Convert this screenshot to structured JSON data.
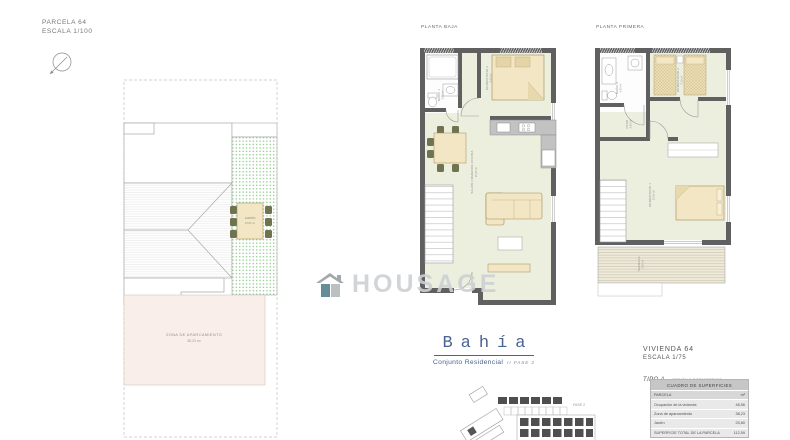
{
  "site": {
    "title": "PARCELA 64",
    "scale": "ESCALA 1/100",
    "garden": {
      "name": "JARDÍN",
      "area": "25,80 m²"
    },
    "parking": {
      "name": "ZONA DE APARCAMIENTO",
      "area": "38,23 m²"
    }
  },
  "plans": {
    "ground": {
      "title": "PLANTA BAJA",
      "bath": {
        "name": "BAÑO 1",
        "area": "3,85 m²"
      },
      "bedroom": {
        "name": "DORMITORIO 2",
        "area": "9,05 m²"
      },
      "living": {
        "name": "SALÓN COMEDOR-COCINA",
        "area": "25,90 m²"
      }
    },
    "first": {
      "title": "PLANTA PRIMERA",
      "bath": {
        "name": "BAÑO 2",
        "area": "4,20 m²"
      },
      "hall": {
        "name": "PASO",
        "area": "2,95 m²"
      },
      "bedroom2": {
        "name": "DORMITORIO 2",
        "area": "9,15 m²"
      },
      "bedroom1": {
        "name": "DORMITORIO 1",
        "area": "10,90 m²"
      },
      "terrace": {
        "name": "TERRAZA",
        "area": "9,60 m²"
      }
    }
  },
  "watermark": {
    "text": "HOUSAGE"
  },
  "brand": {
    "name": "Bahía",
    "subtitle": "Conjunto Residencial",
    "phase": "II FASE 2"
  },
  "unit": {
    "title": "VIVIENDA 64",
    "scale": "ESCALA 1/75",
    "type": "TIPO A",
    "type_note": "- OPCIÓN 3 DORMITORIOS"
  },
  "surfaces": {
    "title": "CUADRO DE SUPERFICIES",
    "header": {
      "label": "PARCELA",
      "unit": "m²"
    },
    "rows": [
      {
        "label": "Ocupación de la vivienda",
        "value": "48,56"
      },
      {
        "label": "Zona de aparcamiento",
        "value": "38,23"
      },
      {
        "label": "Jardín",
        "value": "25,80"
      },
      {
        "label": "SUPERFICIE TOTAL DE LA PARCELA",
        "value": "112,59"
      }
    ]
  },
  "keyplan": {
    "label": "FASE 2"
  },
  "colors": {
    "brand_blue": "#4a6492",
    "wall_gray": "#606060",
    "floor_green": "#ecefde",
    "furniture_tan": "#f2e6c4",
    "garden_green": "#90c98c",
    "parking_pink": "#f9eeea",
    "watermark_gray": "#cdd1d3"
  }
}
